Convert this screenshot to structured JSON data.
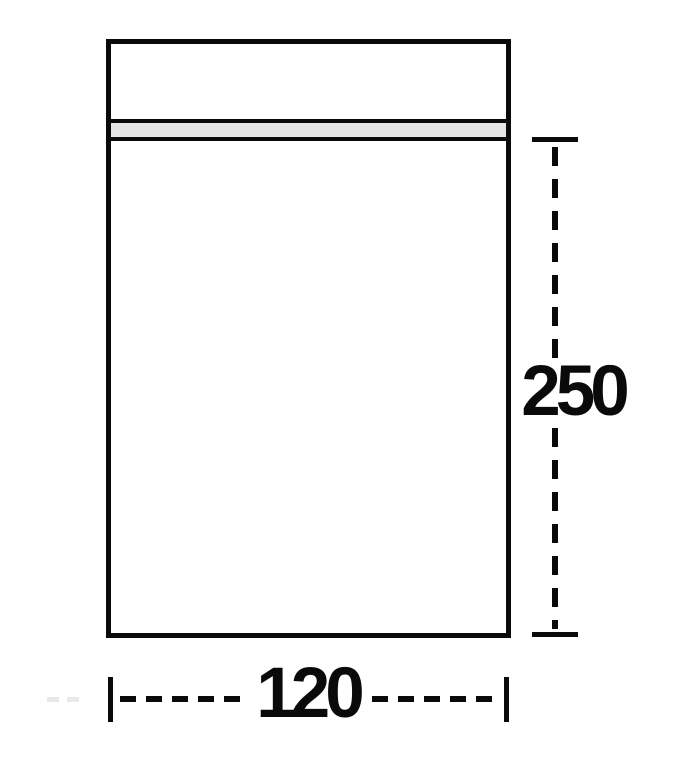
{
  "diagram": {
    "labels": {
      "height_dimension": "250",
      "width_dimension": "120"
    },
    "colors": {
      "line": "#0a0a0a",
      "zip_strip_fill": "#e5e5e5",
      "background": "#ffffff"
    }
  }
}
